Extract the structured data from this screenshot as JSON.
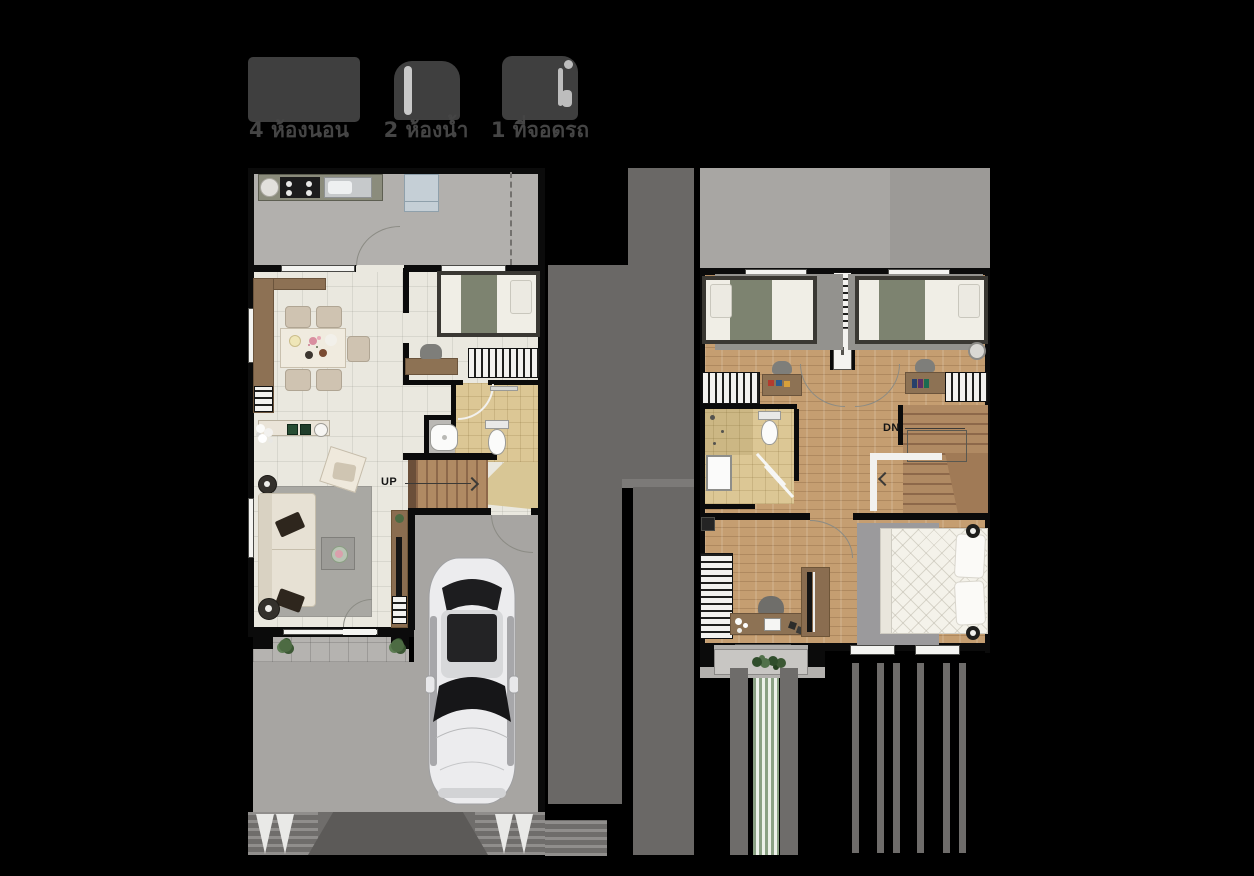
{
  "page": {
    "background": "#000000"
  },
  "summary": {
    "items": [
      {
        "icon": "bed-icon",
        "label": "4 ห้องนอน"
      },
      {
        "icon": "shower-icon",
        "label": "2 ห้องน้ำ"
      },
      {
        "icon": "car-icon",
        "label": "1 ที่จอดรถ"
      }
    ]
  },
  "floor_plans": {
    "first_floor": {
      "stairs_label": "UP"
    },
    "second_floor": {
      "stairs_label": "DN"
    }
  },
  "colors": {
    "icon": "#3f3f3f",
    "label_text": "#454545",
    "wall": "#0b0b0b",
    "floor_cream": "#eae8df",
    "floor_wood": "#c59e71",
    "tile_beige": "#dcc795",
    "concrete": "#a7a5a2",
    "divider": "#6a6866",
    "counter_brown": "#8d7154",
    "blanket_green": "#7d8370"
  }
}
